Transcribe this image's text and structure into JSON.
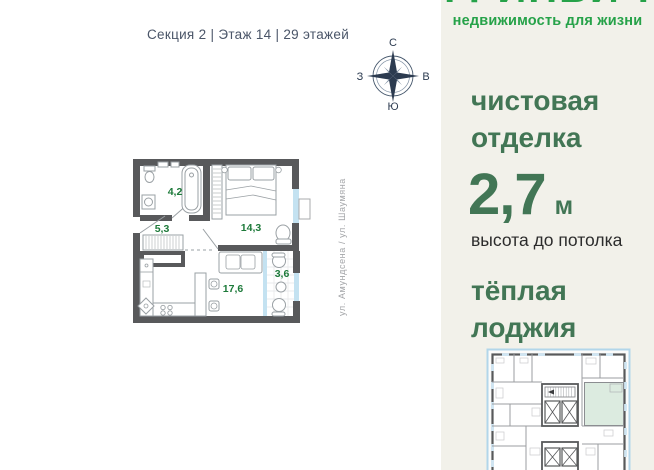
{
  "header": {
    "location_line": "Секция 2 | Этаж 14 | 29 этажей"
  },
  "compass": {
    "north": "С",
    "east": "В",
    "south": "Ю",
    "west": "З"
  },
  "plan": {
    "street_label": "ул. Амундсена / ул. Шаумяна",
    "rooms": {
      "bathroom": "4,2",
      "hall": "5,3",
      "bedroom": "14,3",
      "kitchen_living": "17,6",
      "loggia": "3,6"
    }
  },
  "sidebar": {
    "brand_name": "ГРИНВИЧ",
    "brand_tagline": "недвижимость для жизни",
    "finish_line1": "чистовая",
    "finish_line2": "отделка",
    "ceiling_value": "2,7",
    "ceiling_unit": "м",
    "ceiling_caption": "высота до потолка",
    "loggia_line1": "тёплая",
    "loggia_line2": "лоджия"
  },
  "colors": {
    "brand_green": "#26a249",
    "accent_green": "#427655",
    "area_label_green": "#1d7a3a",
    "sidebar_bg": "#f2f1ea",
    "wall_gray": "#58595b",
    "window_blue": "#c4e2f1",
    "highlighted_unit_green": "#dcebe0"
  }
}
